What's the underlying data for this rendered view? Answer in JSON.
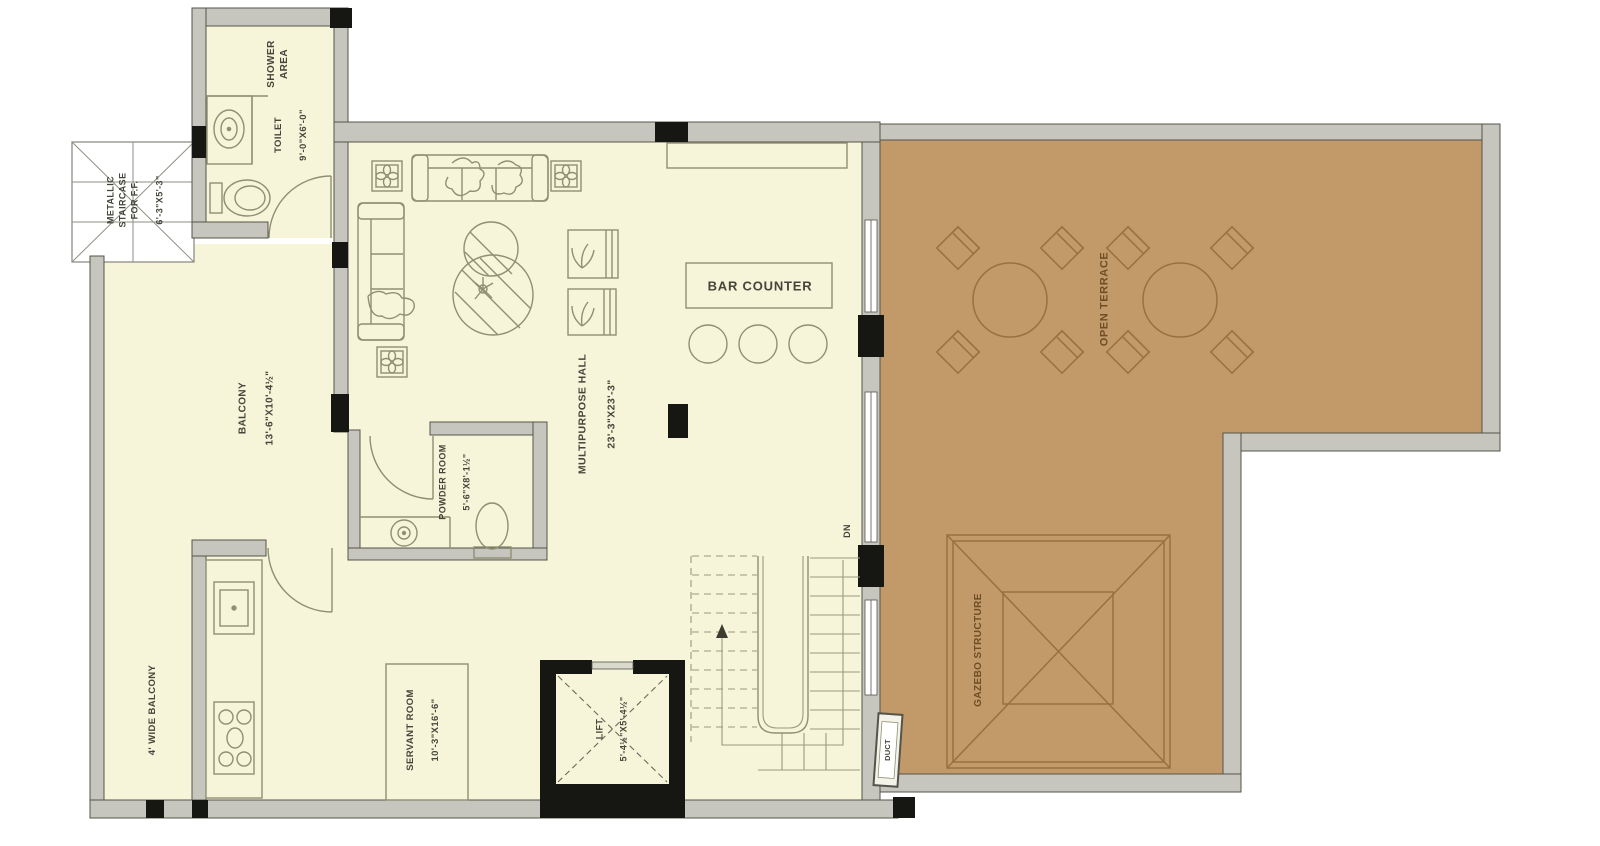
{
  "colors": {
    "floor_cream": "#f6f4d9",
    "terrace_tan": "#c29a69",
    "wall_gray": "#c6c6be",
    "column_black": "#161613",
    "hall_furniture_line": "#8f8f74",
    "terrace_furniture_line": "#97713f",
    "label_text": "#45453a",
    "terrace_label_text": "#6d4e26"
  },
  "rooms": {
    "metallic_staircase": {
      "label": "METALLIC\nSTAIRCASE\nFOR F.F.",
      "dims": "6'-3\"X5'-3\""
    },
    "shower_area": {
      "label": "SHOWER\nAREA"
    },
    "toilet": {
      "label": "TOILET",
      "dims": "9'-0\"X6'-0\""
    },
    "balcony": {
      "label": "BALCONY",
      "dims": "13'-6\"X10'-4½\""
    },
    "wide_balcony": {
      "label": "4' WIDE BALCONY"
    },
    "multipurpose_hall": {
      "label": "MULTIPURPOSE HALL",
      "dims": "23'-3\"X23'-3\""
    },
    "bar_counter": {
      "label": "BAR COUNTER"
    },
    "powder_room": {
      "label": "POWDER ROOM",
      "dims": "5'-6\"X8'-1½\""
    },
    "servant_room": {
      "label": "SERVANT ROOM",
      "dims": "10'-3\"X16'-6\""
    },
    "lift": {
      "label": "LIFT",
      "dims": "5'-4½\"X5'-4½\""
    },
    "open_terrace": {
      "label": "OPEN TERRACE"
    },
    "gazebo": {
      "label": "GAZEBO STRUCTURE"
    },
    "duct": {
      "label": "DUCT"
    },
    "stair_direction": {
      "label": "DN"
    }
  }
}
